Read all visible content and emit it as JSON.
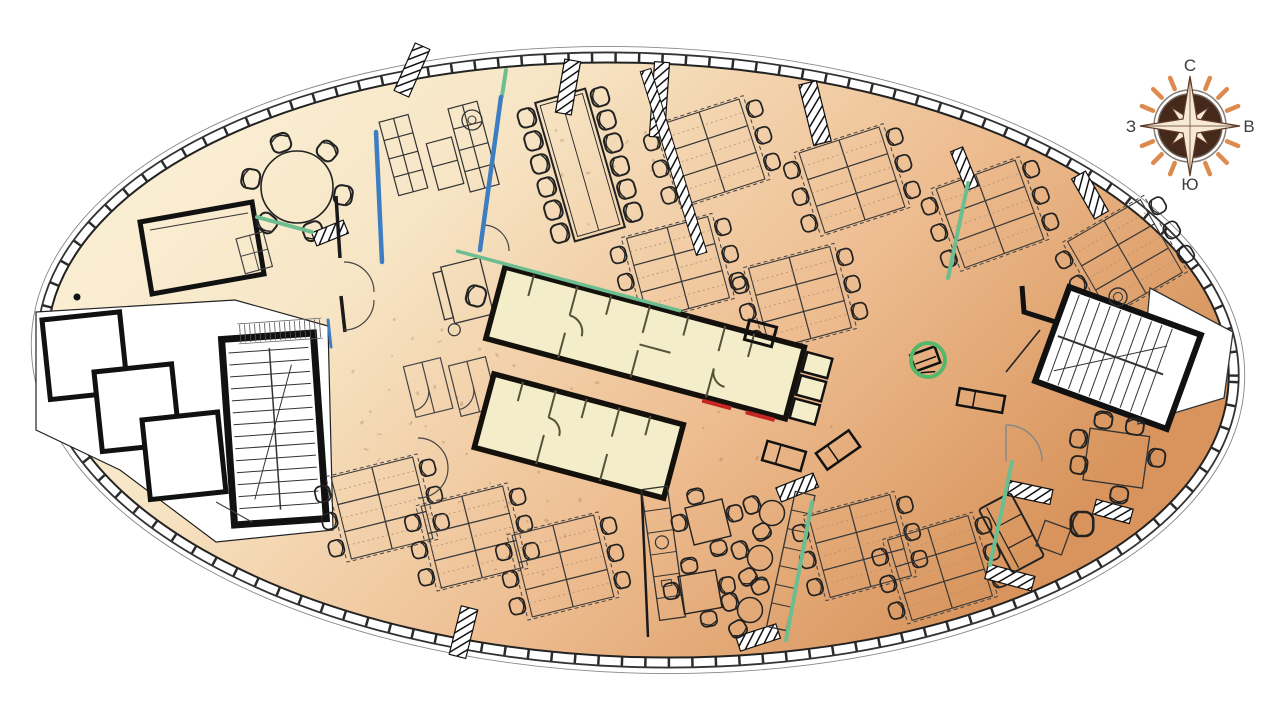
{
  "compass": {
    "labels": {
      "north": "С",
      "east": "В",
      "south": "Ю",
      "west": "З"
    }
  },
  "colors": {
    "floor_light": "#fdf4dc",
    "floor_mid": "#f7e6c6",
    "floor_warm": "#eebe92",
    "floor_dark": "#d8945c",
    "core_fill": "#f3eec9",
    "core_wall": "#14110c",
    "interior_line": "#3a3a3a",
    "core_partition": "#55523a",
    "partition_green": "#6cbd8f",
    "partition_blue": "#3d7dc2",
    "door_red": "#c42723",
    "highlight_green": "#54b86b",
    "stair_fill": "#ffffff",
    "wall_black": "#1b1b1b",
    "door_gray": "#888888",
    "compass_orange": "#dd8a4e",
    "compass_brown": "#452a1c",
    "compass_star_fill": "#f6ead6",
    "compass_star_stroke": "#5f3b28",
    "compass_label_color": "#3c3c3c"
  }
}
